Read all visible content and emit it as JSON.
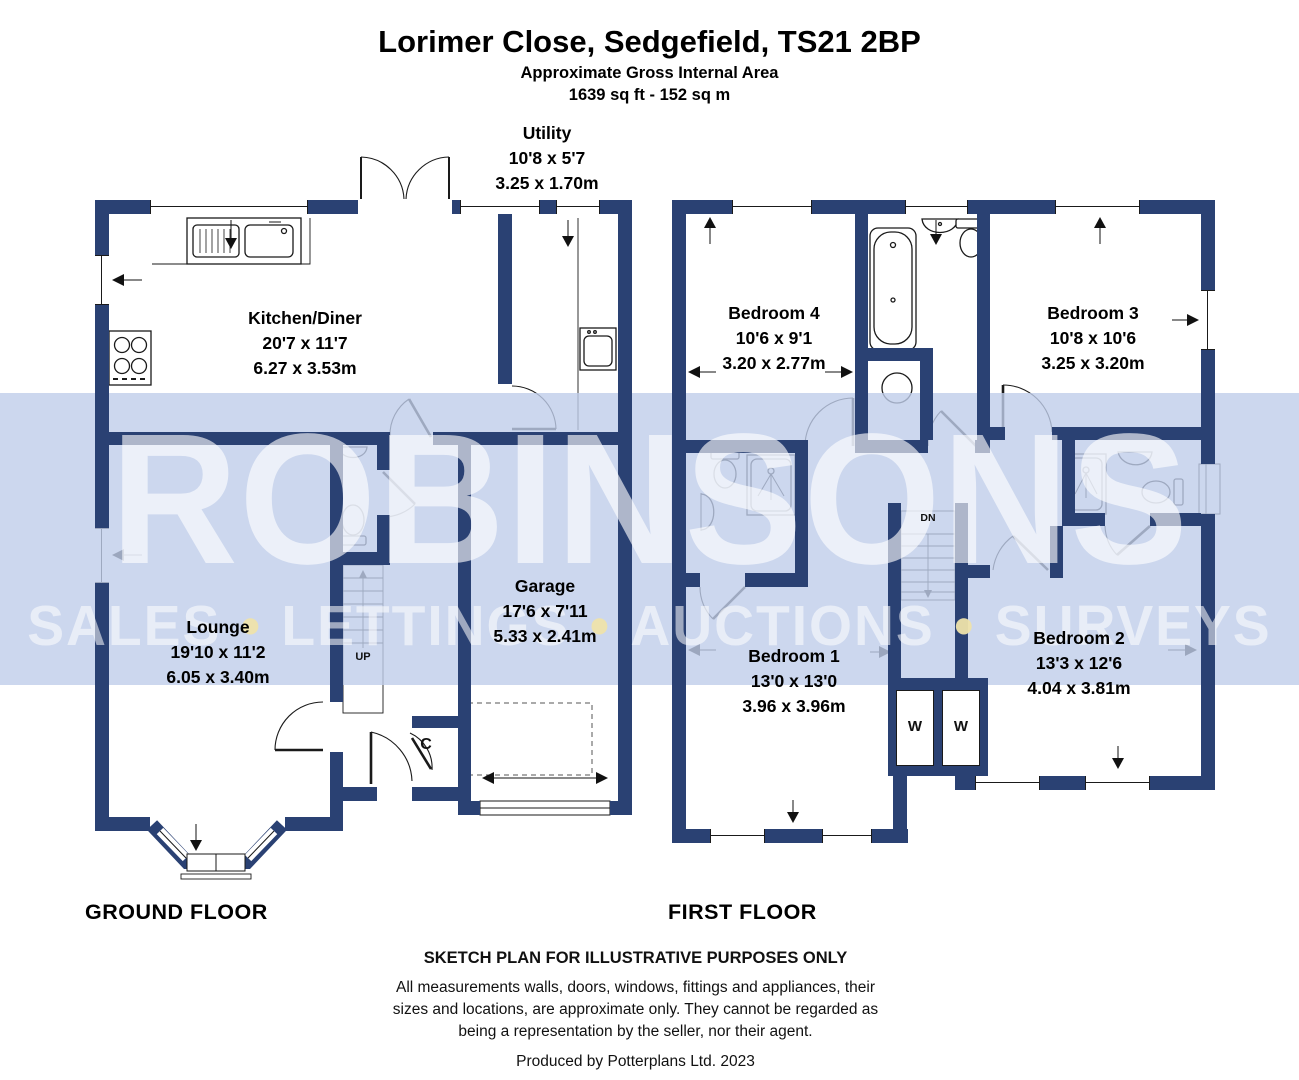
{
  "header": {
    "title": "Lorimer Close, Sedgefield, TS21 2BP",
    "subtitle": "Approximate Gross Internal Area",
    "area_line": "1639 sq ft - 152 sq m"
  },
  "floor_labels": {
    "ground": "GROUND FLOOR",
    "first": "FIRST FLOOR"
  },
  "rooms": {
    "utility": {
      "name": "Utility",
      "imperial": "10'8 x 5'7",
      "metric": "3.25 x 1.70m"
    },
    "kitchen_diner": {
      "name": "Kitchen/Diner",
      "imperial": "20'7 x 11'7",
      "metric": "6.27 x 3.53m"
    },
    "lounge": {
      "name": "Lounge",
      "imperial": "19'10 x 11'2",
      "metric": "6.05 x 3.40m"
    },
    "garage": {
      "name": "Garage",
      "imperial": "17'6 x 7'11",
      "metric": "5.33 x 2.41m"
    },
    "bedroom4": {
      "name": "Bedroom 4",
      "imperial": "10'6 x 9'1",
      "metric": "3.20 x 2.77m"
    },
    "bedroom3": {
      "name": "Bedroom 3",
      "imperial": "10'8 x 10'6",
      "metric": "3.25 x 3.20m"
    },
    "bedroom1": {
      "name": "Bedroom 1",
      "imperial": "13'0 x 13'0",
      "metric": "3.96 x 3.96m"
    },
    "bedroom2": {
      "name": "Bedroom 2",
      "imperial": "13'3 x 12'6",
      "metric": "4.04 x 3.81m"
    }
  },
  "plan_annotations": {
    "stairs_up": "UP",
    "stairs_down": "DN",
    "cupboard": "C",
    "wardrobe_left": "W",
    "wardrobe_right": "W"
  },
  "watermark": {
    "brand": "ROBINSONS",
    "tagline": [
      "SALES",
      "LETTINGS",
      "AUCTIONS",
      "SURVEYS"
    ],
    "separator": "•",
    "band_color": "#ccd7ee",
    "letter_color": "#ffffff",
    "dot_color": "#eee3aa"
  },
  "footer": {
    "sketch_note": "SKETCH PLAN FOR ILLUSTRATIVE PURPOSES ONLY",
    "disclaimer": [
      "All measurements walls, doors, windows, fittings and appliances, their",
      "sizes and locations, are approximate only. They cannot be regarded as",
      "being a representation by the seller, nor their agent."
    ],
    "credit": "Produced by Potterplans Ltd. 2023"
  },
  "colors": {
    "wall": "#2a4173",
    "line": "#1a1a1a",
    "paper": "#ffffff"
  }
}
